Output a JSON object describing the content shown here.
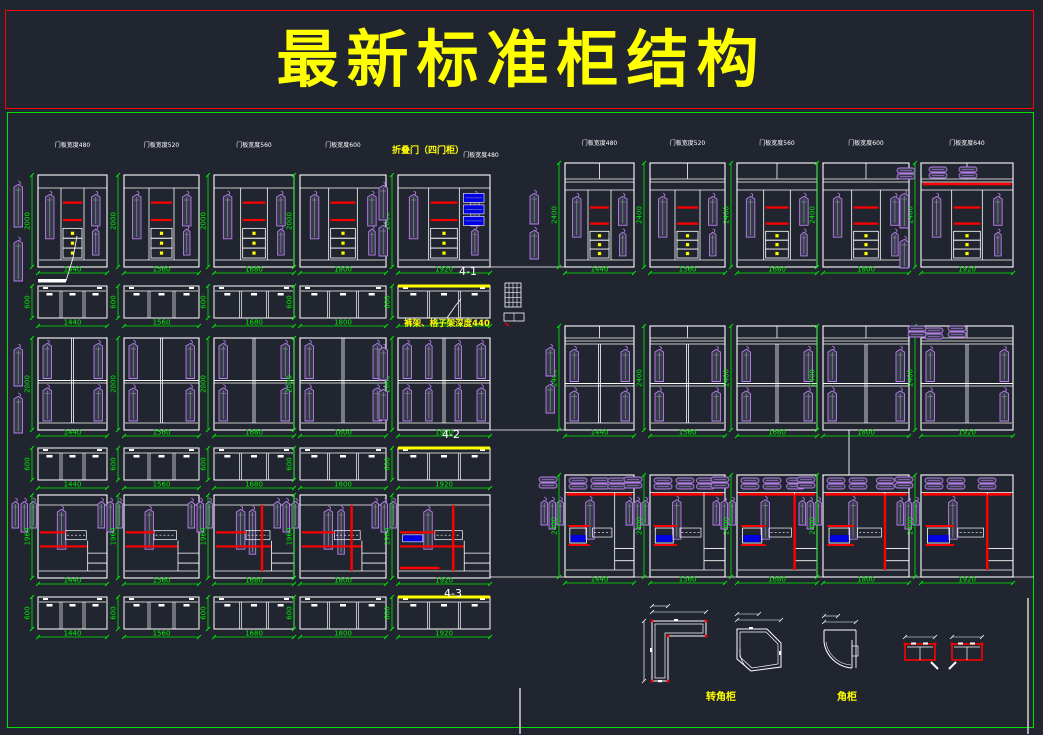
{
  "title": "最新标准柜结构",
  "colors": {
    "bg": "#20252f",
    "line": "#ffffff",
    "dim": "#00ee00",
    "shelf": "#ff0000",
    "clothes": "#bd7df2",
    "clothes_fill": "#343a47",
    "accent": "#ffff00",
    "blue": "#0000e0",
    "title_border": "#ff0000",
    "main_border": "#00e000"
  },
  "annotations": [
    {
      "text": "折叠门（四门柜）",
      "x": 428,
      "y": 153,
      "size": 9,
      "color": "accent",
      "bold": true
    },
    {
      "text": "门板宽度480",
      "x": 481,
      "y": 157,
      "size": 6,
      "color": "line",
      "bold": false
    },
    {
      "text": "4-1",
      "x": 468,
      "y": 275,
      "size": 11,
      "color": "line",
      "bold": false
    },
    {
      "text": "裤架、格子架深度440",
      "x": 447,
      "y": 326,
      "size": 8.5,
      "color": "accent",
      "bold": true
    },
    {
      "text": "4-2",
      "x": 451,
      "y": 438,
      "size": 11,
      "color": "line",
      "bold": false
    },
    {
      "text": "4-3",
      "x": 453,
      "y": 597,
      "size": 11,
      "color": "line",
      "bold": false
    },
    {
      "text": "转角柜",
      "x": 721,
      "y": 700,
      "size": 10,
      "color": "accent",
      "bold": true
    },
    {
      "text": "角柜",
      "x": 847,
      "y": 700,
      "size": 10,
      "color": "accent",
      "bold": true
    }
  ],
  "rows": [
    {
      "name": "wardrobes-2000-three-door",
      "type": "threeDoor",
      "y": 175,
      "h": 92,
      "hdim": "2000",
      "labelY": 147,
      "cabs": [
        {
          "x": 38,
          "w": 69,
          "dim": "1440",
          "label": "门板宽度480"
        },
        {
          "x": 124,
          "w": 75,
          "dim": "1560",
          "label": "门板宽度520"
        },
        {
          "x": 214,
          "w": 80,
          "dim": "1680",
          "label": "门板宽度560"
        },
        {
          "x": 300,
          "w": 86,
          "dim": "1800",
          "label": "门板宽度600"
        },
        {
          "x": 398,
          "w": 92,
          "dim": "1920",
          "blue": true
        }
      ],
      "topbox": {
        "y": 286,
        "h": 32,
        "hdim": "600",
        "yellowIdx": 4
      }
    },
    {
      "name": "wardrobes-2400-three-door",
      "type": "threeDoorTall",
      "y": 163,
      "h": 104,
      "hdim": "2400",
      "labelY": 145,
      "cabs": [
        {
          "x": 565,
          "w": 69,
          "dim": "1440",
          "label": "门板宽度480"
        },
        {
          "x": 650,
          "w": 75,
          "dim": "1560",
          "label": "门板宽度520"
        },
        {
          "x": 737,
          "w": 80,
          "dim": "1680",
          "label": "门板宽度560"
        },
        {
          "x": 823,
          "w": 86,
          "dim": "1800",
          "label": "门板宽度600"
        },
        {
          "x": 921,
          "w": 92,
          "dim": "1920",
          "label": "门板宽度640",
          "folded": true
        }
      ],
      "topbox": null
    },
    {
      "name": "wardrobes-2000-sliding",
      "type": "slide",
      "y": 338,
      "h": 92,
      "hdim": "2000",
      "cabs": [
        {
          "x": 38,
          "w": 69,
          "dim": "1440"
        },
        {
          "x": 124,
          "w": 75,
          "dim": "1560"
        },
        {
          "x": 214,
          "w": 80,
          "dim": "1680"
        },
        {
          "x": 300,
          "w": 86,
          "dim": "1800"
        },
        {
          "x": 398,
          "w": 92,
          "dim": "1920",
          "dense": true
        }
      ],
      "topbox": {
        "y": 448,
        "h": 32,
        "hdim": "600",
        "yellowIdx": 4
      }
    },
    {
      "name": "wardrobes-2400-sliding",
      "type": "slideTall",
      "y": 326,
      "h": 104,
      "hdim": "2400",
      "cabs": [
        {
          "x": 565,
          "w": 69,
          "dim": "1440"
        },
        {
          "x": 650,
          "w": 75,
          "dim": "1560"
        },
        {
          "x": 737,
          "w": 80,
          "dim": "1680"
        },
        {
          "x": 823,
          "w": 86,
          "dim": "1800"
        },
        {
          "x": 921,
          "w": 92,
          "dim": "1920",
          "folded": true
        }
      ],
      "topbox": null
    },
    {
      "name": "wardrobes-1960-combo",
      "type": "comboA",
      "y": 495,
      "h": 83,
      "hdim": "1960",
      "cabs": [
        {
          "x": 38,
          "w": 69,
          "dim": "1440"
        },
        {
          "x": 124,
          "w": 75,
          "dim": "1560"
        },
        {
          "x": 214,
          "w": 80,
          "dim": "1680",
          "redv": true
        },
        {
          "x": 300,
          "w": 86,
          "dim": "1800",
          "redv": true
        },
        {
          "x": 398,
          "w": 92,
          "dim": "1920",
          "redv": true,
          "blue": true
        }
      ],
      "topbox": {
        "y": 597,
        "h": 32,
        "hdim": "600",
        "yellowIdx": 4
      }
    },
    {
      "name": "wardrobes-2400-combo",
      "type": "comboB",
      "y": 475,
      "h": 102,
      "hdim": "2400",
      "cabs": [
        {
          "x": 565,
          "w": 69,
          "dim": "1440"
        },
        {
          "x": 650,
          "w": 75,
          "dim": "1560"
        },
        {
          "x": 737,
          "w": 80,
          "dim": "1680",
          "redv": true
        },
        {
          "x": 823,
          "w": 86,
          "dim": "1800",
          "redv": true
        },
        {
          "x": 921,
          "w": 92,
          "dim": "1920",
          "redv": true
        }
      ],
      "topbox": null
    }
  ],
  "extra_coats": [
    [
      14,
      181,
      46
    ],
    [
      14,
      237,
      44
    ],
    [
      379,
      182,
      38
    ],
    [
      379,
      222,
      34
    ],
    [
      530,
      190,
      34
    ],
    [
      530,
      227,
      32
    ],
    [
      900,
      190,
      38
    ],
    [
      900,
      236,
      32
    ],
    [
      14,
      344,
      42
    ],
    [
      14,
      393,
      40
    ],
    [
      379,
      344,
      36
    ],
    [
      379,
      386,
      34
    ],
    [
      546,
      344,
      32
    ],
    [
      546,
      381,
      32
    ]
  ],
  "extra_folded": [
    [
      897,
      168
    ],
    [
      908,
      326
    ],
    [
      948,
      326
    ]
  ],
  "plain_lines": [
    {
      "x1": 486,
      "y1": 267,
      "x2": 566,
      "y2": 267,
      "c": "line",
      "w": 0.8
    },
    {
      "x1": 490,
      "y1": 430,
      "x2": 566,
      "y2": 430,
      "c": "line",
      "w": 0.8
    },
    {
      "x1": 490,
      "y1": 577,
      "x2": 1034,
      "y2": 577,
      "c": "line",
      "w": 0.8
    },
    {
      "x1": 849,
      "y1": 430,
      "x2": 849,
      "y2": 482,
      "c": "line",
      "w": 0.9
    },
    {
      "x1": 520,
      "y1": 688,
      "x2": 520,
      "y2": 734,
      "c": "line",
      "w": 1.2
    },
    {
      "x1": 1028,
      "y1": 598,
      "x2": 1028,
      "y2": 734,
      "c": "line",
      "w": 1.2
    }
  ],
  "leaders": [
    "66,281 73,258 77,236",
    "447,318 456,305 461,299"
  ],
  "corner_plans": {
    "l_shape_x": 652,
    "l_shape_y": 621,
    "diagonal_x": 737,
    "diagonal_y": 629,
    "quarter_x": 824,
    "quarter_y": 630,
    "detail1_x": 905,
    "detail1_y": 644,
    "detail2_x": 952,
    "detail2_y": 644
  }
}
